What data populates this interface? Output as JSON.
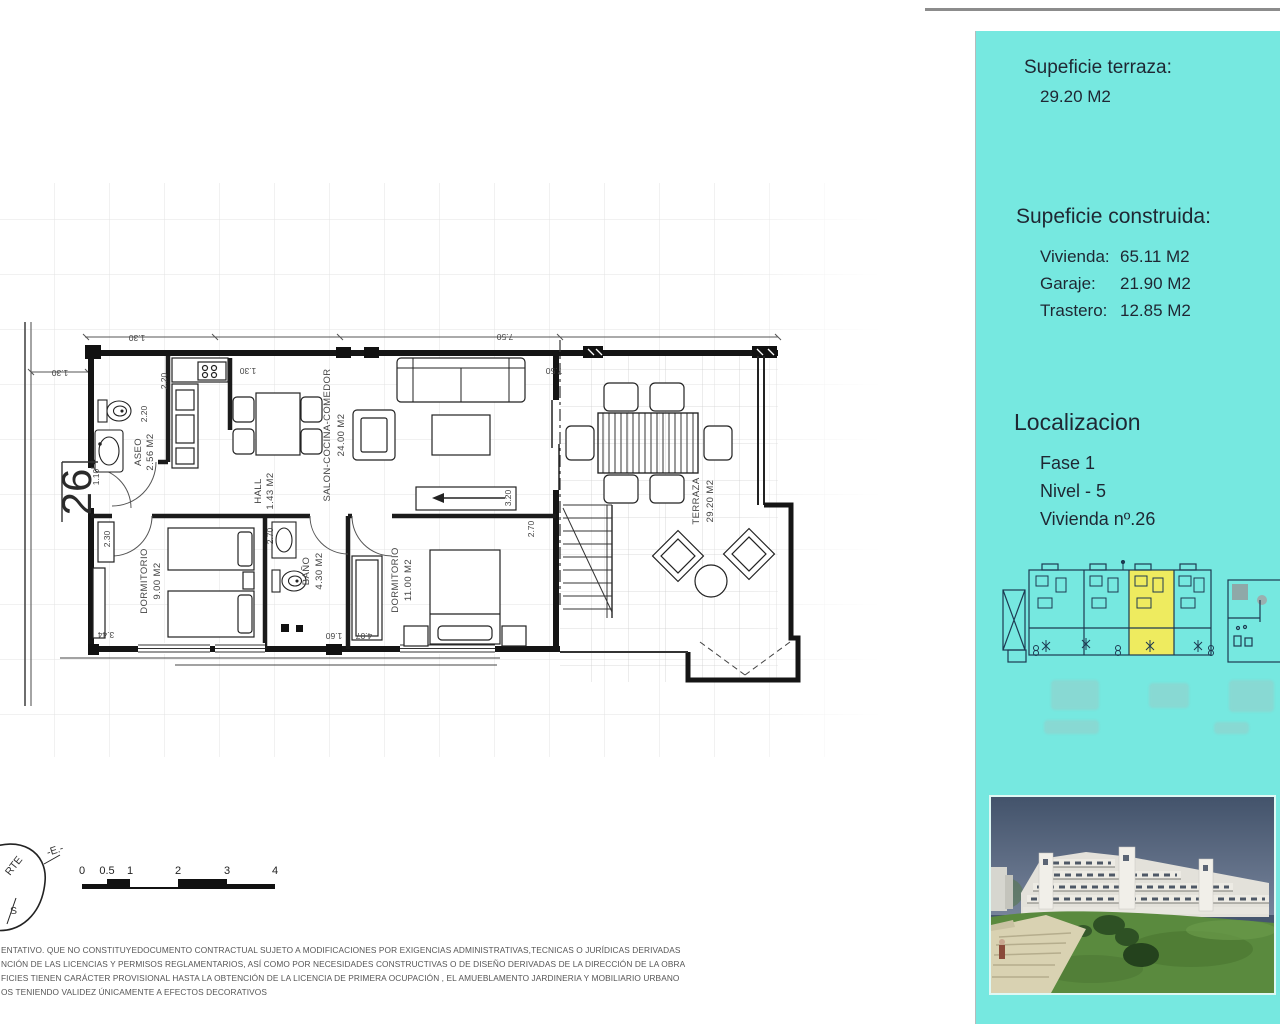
{
  "sidebar": {
    "bg": "#76e8e0",
    "terrace": {
      "title": "Supeficie terraza:",
      "value": "29.20 M2"
    },
    "built": {
      "title": "Supeficie construida:",
      "items": [
        {
          "label": "Vivienda:",
          "value": "65.11 M2"
        },
        {
          "label": "Garaje:",
          "value": "21.90 M2"
        },
        {
          "label": "Trastero:",
          "value": "12.85 M2"
        }
      ]
    },
    "location": {
      "title": "Localizacion",
      "items": [
        {
          "text": "Fase 1"
        },
        {
          "text": "Nivel - 5"
        },
        {
          "text": "Vivienda nº.26"
        }
      ]
    },
    "siteplan": {
      "highlight_color": "#eeeb5f"
    }
  },
  "plan": {
    "unit_number": "26",
    "rooms": [
      {
        "name": "ASEO",
        "area": "2.56 M2"
      },
      {
        "name": "HALL",
        "area": "1.43 M2"
      },
      {
        "name": "SALON-COCINA-COMEDOR",
        "area": "24.00 M2"
      },
      {
        "name": "DORMITORIO",
        "area": "9.00 M2"
      },
      {
        "name": "BAÑO",
        "area": "4.30 M2"
      },
      {
        "name": "DORMITORIO",
        "area": "11.00 M2"
      },
      {
        "name": "TERRAZA",
        "area": "29.20 M2"
      }
    ],
    "dims": [
      {
        "t": "1.30"
      },
      {
        "t": "1.30"
      },
      {
        "t": "1.30"
      },
      {
        "t": "7.50"
      },
      {
        "t": "7.50"
      },
      {
        "t": "2.20"
      },
      {
        "t": "2.20"
      },
      {
        "t": "1.10"
      },
      {
        "t": "2.30"
      },
      {
        "t": "2.70"
      },
      {
        "t": "2.70"
      },
      {
        "t": "3.20"
      },
      {
        "t": "3.44"
      },
      {
        "t": "1.60"
      },
      {
        "t": "4.07"
      }
    ],
    "compass": {
      "north": "RTE",
      "east": "-E.-",
      "south": "S"
    },
    "scale_ticks": [
      {
        "t": "0"
      },
      {
        "t": "0.5"
      },
      {
        "t": "1"
      },
      {
        "t": "2"
      },
      {
        "t": "3"
      },
      {
        "t": "4"
      }
    ]
  },
  "disclaimer": {
    "lines": [
      {
        "text": "ENTATIVO. QUE NO CONSTITUYEDOCUMENTO CONTRACTUAL SUJETO A MODIFICACIONES POR EXIGENCIAS ADMINISTRATIVAS,TECNICAS O JURÍDICAS DERIVADAS"
      },
      {
        "text": "NCIÓN DE LAS LICENCIAS Y PERMISOS REGLAMENTARIOS, ASÍ COMO POR NECESIDADES CONSTRUCTIVAS  O DE DISEÑO DERIVADAS DE LA DIRECCIÓN DE LA OBRA"
      },
      {
        "text": "FICIES TIENEN CARÁCTER PROVISIONAL HASTA LA OBTENCIÓN DE LA LICENCIA DE PRIMERA OCUPACIÓN , EL AMUEBLAMENTO JARDINERIA Y MOBILIARIO URBANO"
      },
      {
        "text": "OS TENIENDO VALIDEZ ÚNICAMENTE  A EFECTOS DECORATIVOS"
      }
    ]
  }
}
